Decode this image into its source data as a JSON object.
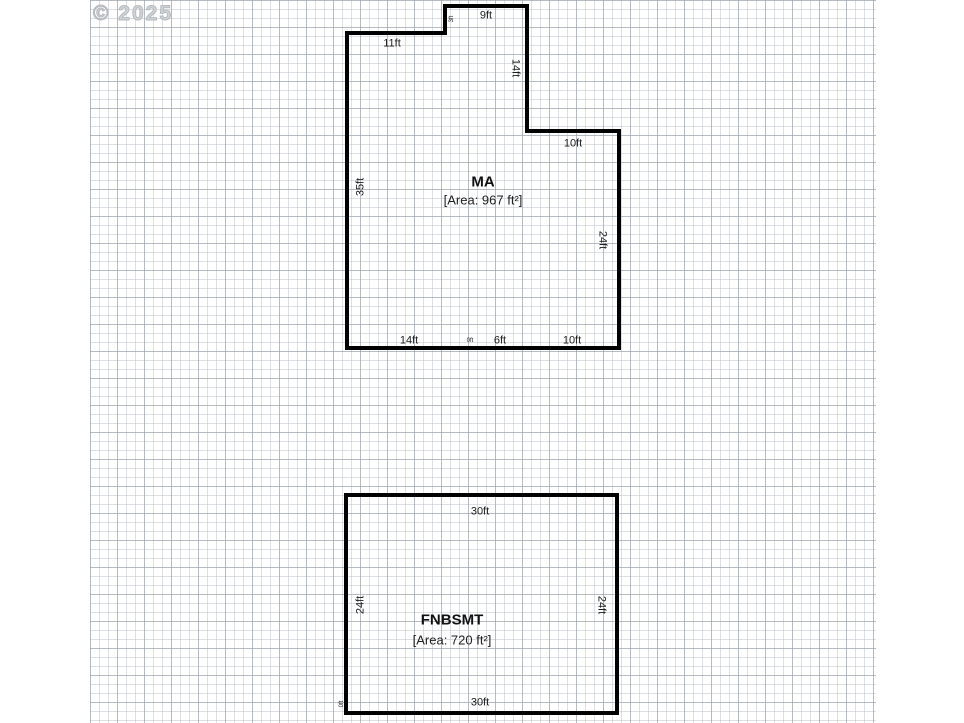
{
  "watermark": "© 2025",
  "plans": [
    {
      "name": "MA",
      "area_label": "[Area: 967 ft²]",
      "dims": {
        "top": "9ft",
        "notch_step": "3ft",
        "upper_left": "11ft",
        "right_upper": "14ft",
        "step_right": "10ft",
        "left": "35ft",
        "right": "24ft",
        "bottom_1": "14ft",
        "bottom_tiny": "0ft",
        "bottom_2": "6ft",
        "bottom_3": "10ft"
      }
    },
    {
      "name": "FNBSMT",
      "area_label": "[Area: 720 ft²]",
      "dims": {
        "top": "30ft",
        "bottom": "30ft",
        "left": "24ft",
        "right": "24ft",
        "corner_tiny": "0ft"
      }
    }
  ]
}
